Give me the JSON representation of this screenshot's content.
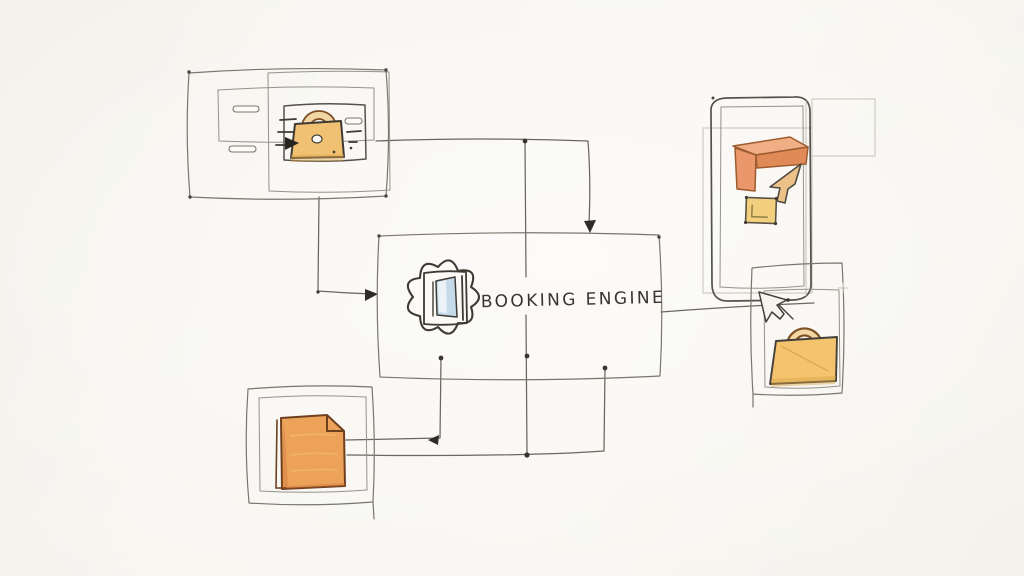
{
  "canvas": {
    "background": "#f7f5f0"
  },
  "palette": {
    "ink": "#3f3a33",
    "box_line": "#7a766c",
    "connector": "#6b675f",
    "lock_tan": "#f0c173",
    "shackle_fill": "#f2d7a4",
    "shackle_line": "#7e5026",
    "doc_orange": "#eca259",
    "doc_shade": "#e08b4a",
    "bracket_salmon": "#efae83",
    "bracket_face": "#e08a58",
    "square_yellow": "#f1cf7c",
    "gold_lock": "#f3c36e",
    "window_blue": "#c6dbea",
    "cursor_tan": "#ecc289",
    "arrow_black": "#282420"
  },
  "center_node": {
    "label": "BOOKING ENGINE",
    "icon": "gear-icon"
  },
  "nodes": {
    "listing_card": {
      "icon": "padlock-icon",
      "decoration": "speed-lines"
    },
    "mobile_app": {
      "icons": [
        "corner-bracket-icon",
        "cursor-icon",
        "app-square-icon"
      ]
    },
    "secure_checkout": {
      "icons": [
        "cursor-icon",
        "padlock-icon"
      ]
    },
    "document": {
      "icon": "note-icon"
    }
  }
}
